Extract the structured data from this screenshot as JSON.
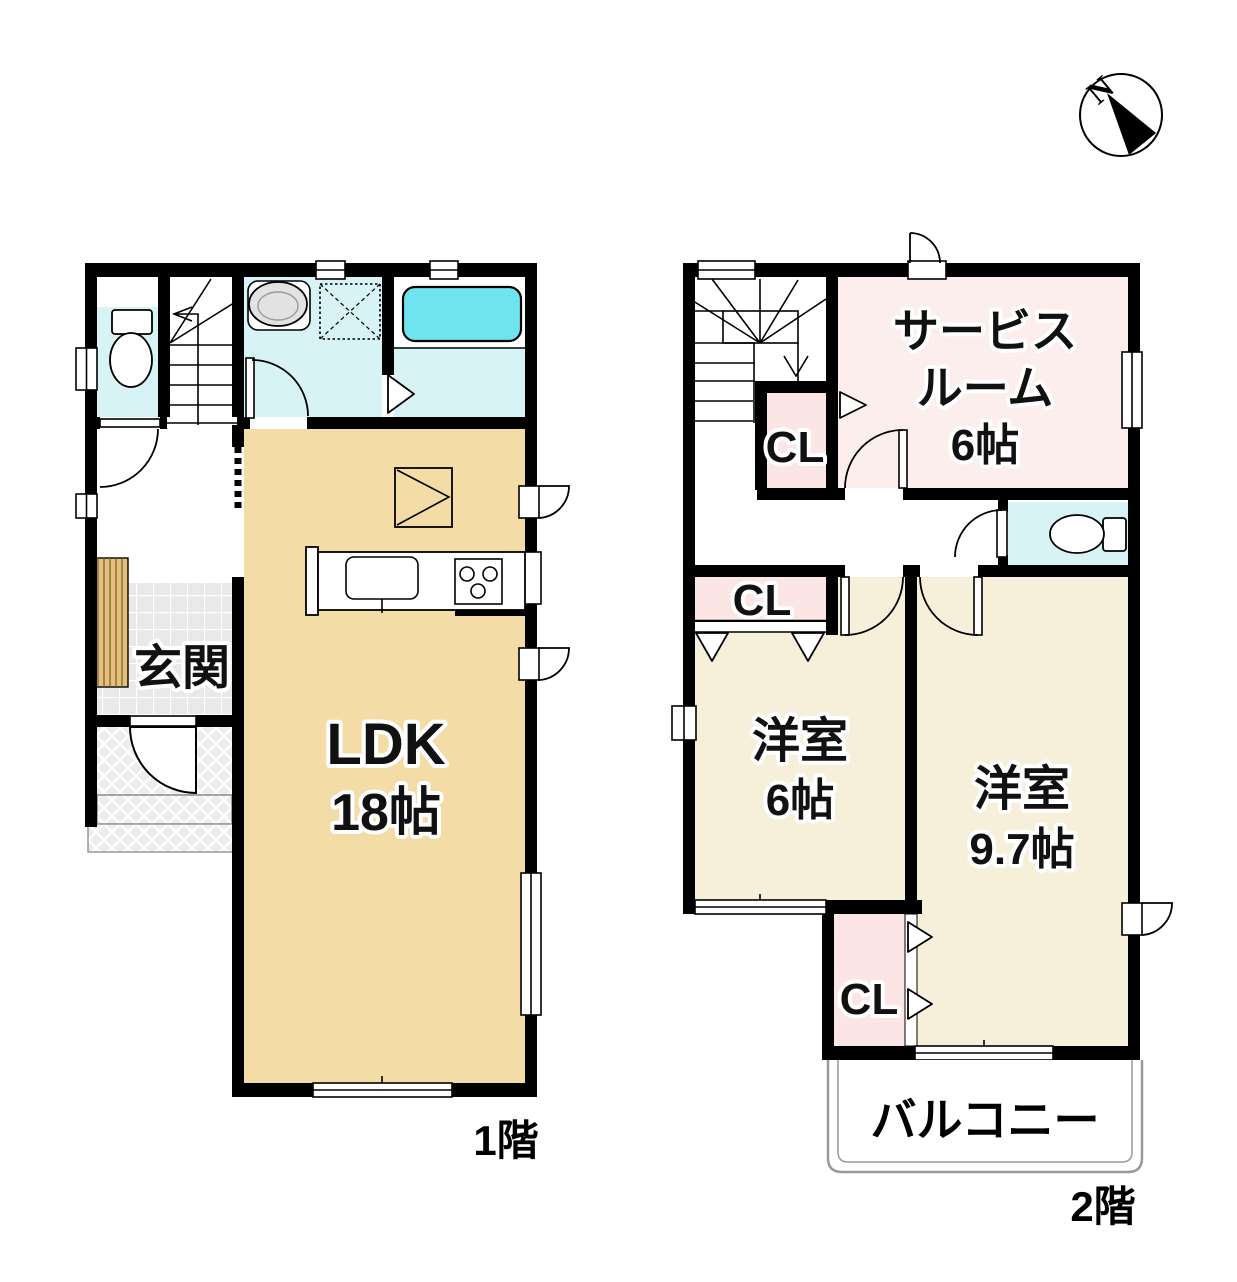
{
  "compass": {
    "north_label": "N"
  },
  "floor1": {
    "name": "1階",
    "rooms": {
      "genkan": "玄関",
      "ldk_name": "LDK",
      "ldk_size": "18帖"
    }
  },
  "floor2": {
    "name": "2階",
    "rooms": {
      "service_name1": "サービス",
      "service_name2": "ルーム",
      "service_size": "6帖",
      "closet_by_stairs": "CL",
      "closet_west": "CL",
      "closet_south": "CL",
      "western6_name": "洋室",
      "western6_size": "6帖",
      "western97_name": "洋室",
      "western97_size": "9.7帖",
      "balcony": "バルコニー"
    }
  },
  "colors": {
    "wall": "#000000",
    "wet_room_cyan": "#d8f3f5",
    "bathtub_cyan": "#6ee4ee",
    "ldk_beige": "#f3dca6",
    "bedroom_cream": "#f6efd9",
    "service_pink": "#fceeec",
    "closet_pink": "#fbe5e5",
    "tile_gray": "#e9e9e9",
    "porch_gray": "#ededed",
    "wood_step": "#e5bf7e"
  }
}
